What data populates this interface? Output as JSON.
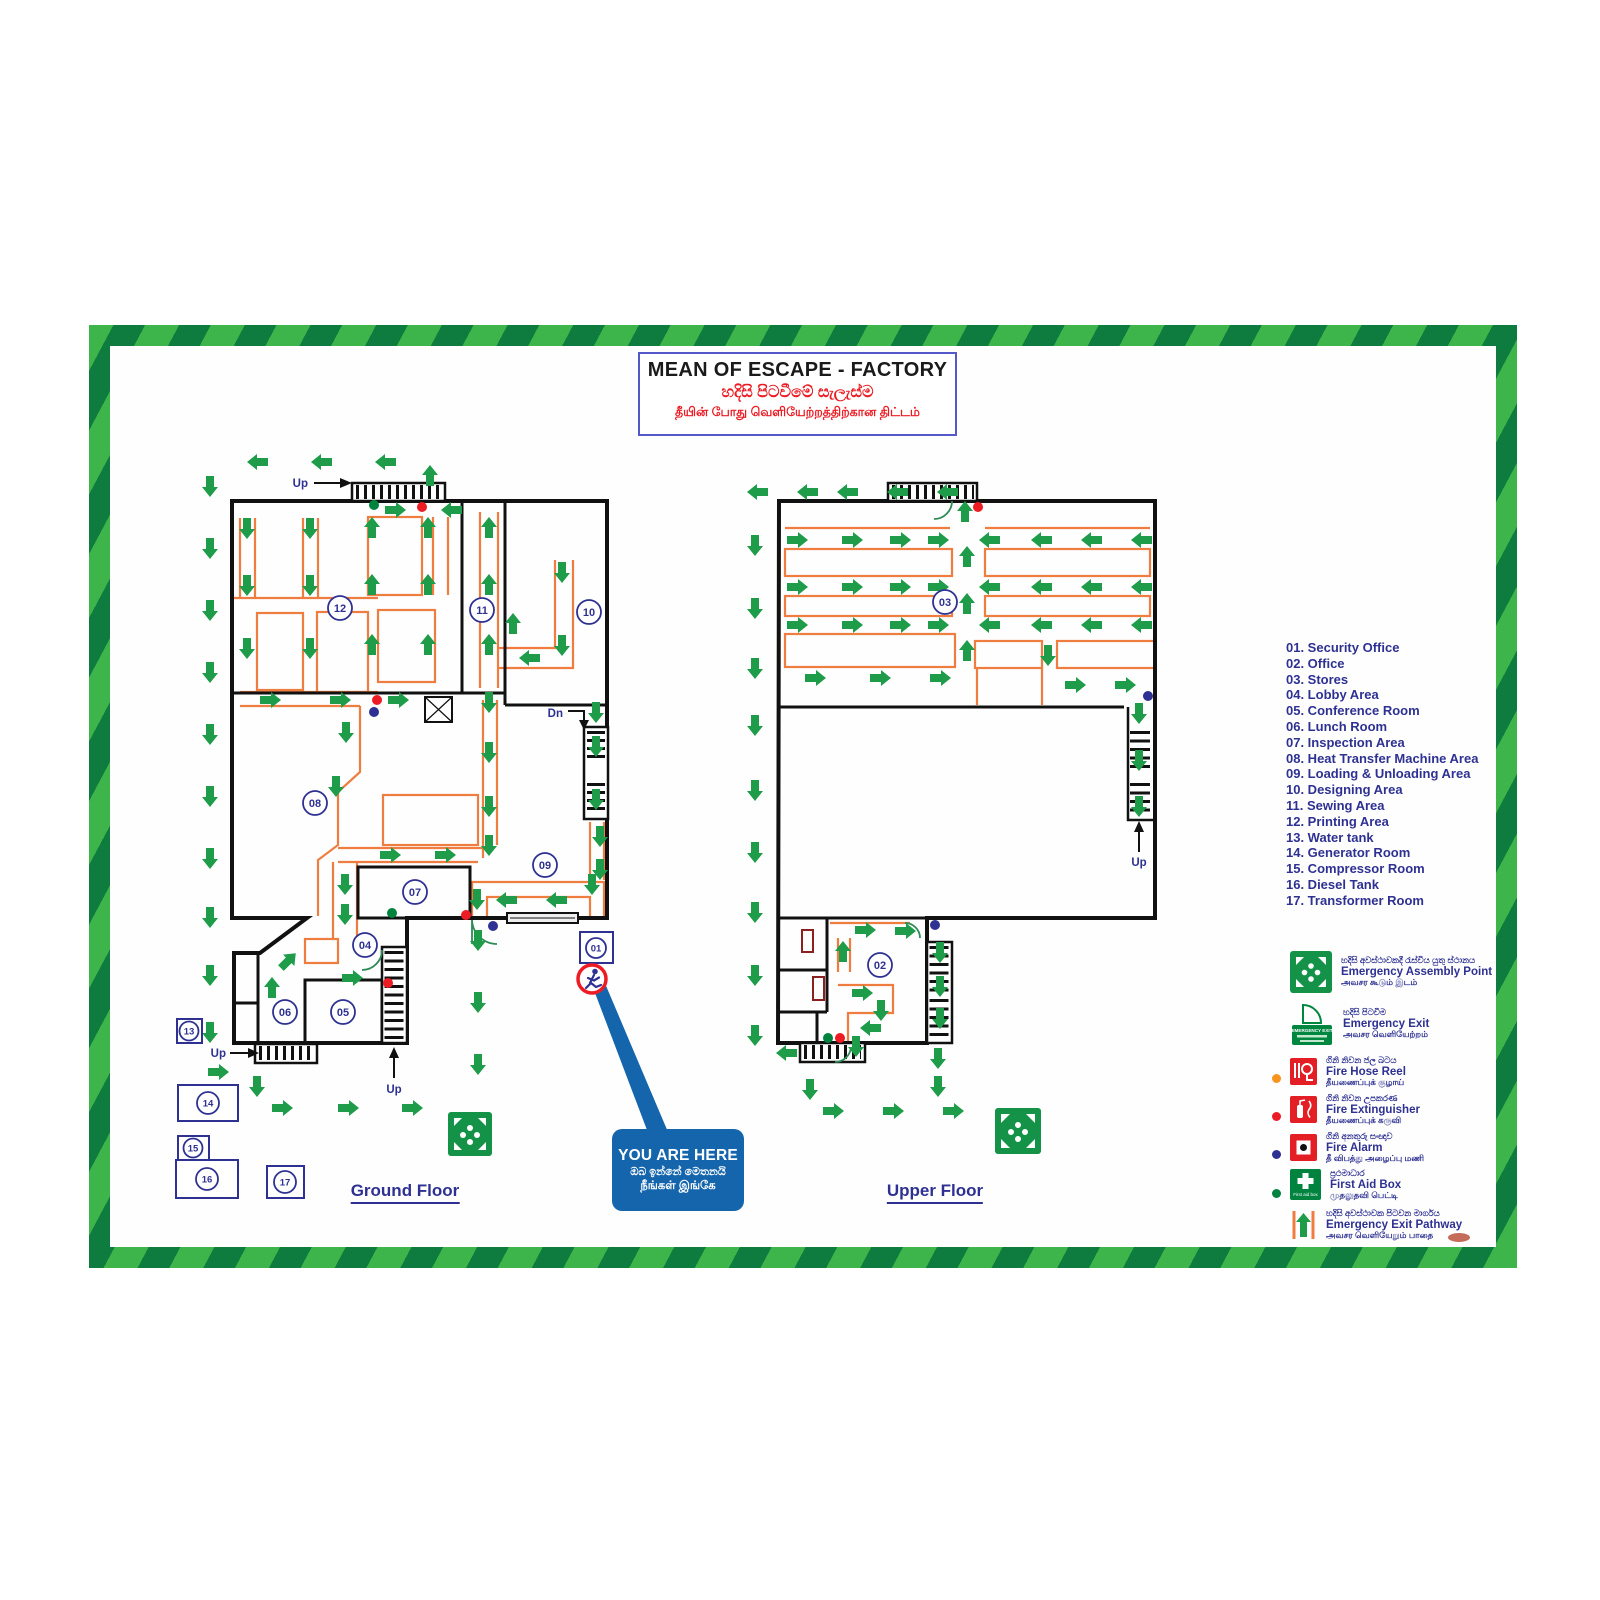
{
  "title": {
    "en": "MEAN OF ESCAPE - FACTORY",
    "si": "හදිසි පිටවීමේ සැලැස්ම",
    "ta": "தீயின் போது வெளியேற்றத்திற்கான திட்டம்"
  },
  "floors": {
    "ground": {
      "label": "Ground Floor"
    },
    "upper": {
      "label": "Upper Floor"
    }
  },
  "rooms": [
    {
      "num": "01",
      "name": "Security Office",
      "label": "01. Security Office"
    },
    {
      "num": "02",
      "name": "Office",
      "label": "02. Office"
    },
    {
      "num": "03",
      "name": "Stores",
      "label": "03. Stores"
    },
    {
      "num": "04",
      "name": "Lobby Area",
      "label": "04. Lobby Area"
    },
    {
      "num": "05",
      "name": "Conference Room",
      "label": "05. Conference Room"
    },
    {
      "num": "06",
      "name": "Lunch Room",
      "label": "06. Lunch Room"
    },
    {
      "num": "07",
      "name": "Inspection Area",
      "label": "07. Inspection Area"
    },
    {
      "num": "08",
      "name": "Heat Transfer Machine Area",
      "label": "08. Heat Transfer Machine Area"
    },
    {
      "num": "09",
      "name": "Loading & Unloading Area",
      "label": "09. Loading & Unloading Area"
    },
    {
      "num": "10",
      "name": "Designing Area",
      "label": "10. Designing Area"
    },
    {
      "num": "11",
      "name": "Sewing Area",
      "label": "11. Sewing Area"
    },
    {
      "num": "12",
      "name": "Printing Area",
      "label": "12. Printing Area"
    },
    {
      "num": "13",
      "name": "Water tank",
      "label": "13. Water tank"
    },
    {
      "num": "14",
      "name": "Generator Room",
      "label": "14. Generator Room"
    },
    {
      "num": "15",
      "name": "Compressor Room",
      "label": "15. Compressor Room"
    },
    {
      "num": "16",
      "name": "Diesel Tank",
      "label": "16. Diesel Tank"
    },
    {
      "num": "17",
      "name": "Transformer Room",
      "label": "17. Transformer Room"
    }
  ],
  "legend": {
    "symbols": [
      {
        "id": "emergency-assembly-point",
        "si": "හදිසි අවස්ථාවකදී රැස්විය යුතු ස්ථානය",
        "en": "Emergency Assembly Point",
        "ta": "அவசர கூடும் இடம்"
      },
      {
        "id": "emergency-exit",
        "si": "හදිසි පිටවීම",
        "en": "Emergency Exit",
        "ta": "அவசர வெளியேற்றம்",
        "sign_text": "EMERGENCY EXIT"
      },
      {
        "id": "fire-hose-reel",
        "si": "ගිනි නිවන ජල බටය",
        "en": "Fire Hose Reel",
        "ta": "தீயணைப்புக் குழாய்",
        "dot": "#f7941d"
      },
      {
        "id": "fire-extinguisher",
        "si": "ගිනි නිවන උපකරණ",
        "en": "Fire Extinguisher",
        "ta": "தீயணைப்புக் கருவி",
        "dot": "#ed1c24"
      },
      {
        "id": "fire-alarm",
        "si": "ගිනි අනතුරු සංඥාව",
        "en": "Fire Alarm",
        "ta": "தீ விபத்து அழைப்பு மணி",
        "dot": "#2e3192"
      },
      {
        "id": "first-aid-box",
        "si": "ප්‍රථමාධාර",
        "en": "First Aid Box",
        "ta": "முதலுதவி பெட்டி",
        "dot": "#00833e",
        "icon_text": "First aid box"
      },
      {
        "id": "emergency-exit-pathway",
        "si": "හදිසි අවස්ථාවක පිටවන මාර්ගය",
        "en": "Emergency Exit Pathway",
        "ta": "அவசர வெளியேறும் பாதை"
      }
    ]
  },
  "you_are_here": {
    "en": "YOU ARE HERE",
    "si": "ඔබ ඉන්නේ මෙතනයි",
    "ta": "நீங்கள் இங்கே"
  },
  "labels": {
    "up": "Up",
    "dn": "Dn"
  },
  "colors": {
    "arrow_green": "#1e9c49",
    "path_orange": "#ef7d3f",
    "wall_black": "#111111",
    "navy": "#2e3192",
    "red": "#ed1c24",
    "callout_blue": "#1565ad",
    "border_light_green": "#3db54a",
    "border_dark_green": "#0f7c3f",
    "assembly_green": "#149247"
  }
}
